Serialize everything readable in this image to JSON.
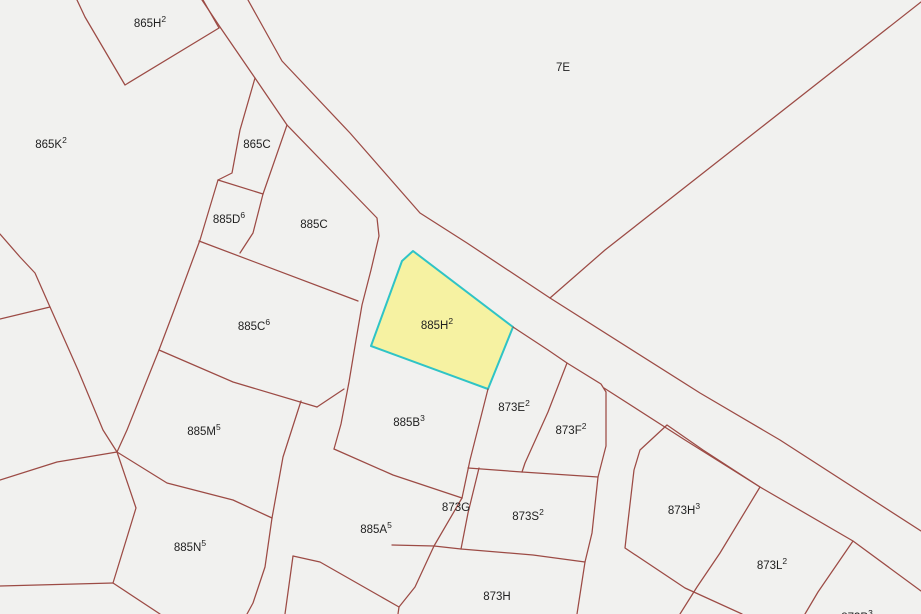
{
  "map": {
    "title": "Cadastral parcel map",
    "width": 921,
    "height": 614,
    "background_color": "#f1f1ef",
    "boundary_color": "#9c4b45",
    "label_color": "#1f1f1f",
    "label_font_size": 11.5,
    "sup_font_size": 8.5,
    "highlight": {
      "parcel": "885H2",
      "fill": "#f6f2a2",
      "stroke": "#2fc4c6",
      "stroke_width": 2,
      "points": [
        [
          413,
          251
        ],
        [
          402,
          261
        ],
        [
          371,
          346
        ],
        [
          488,
          389
        ],
        [
          513,
          327
        ]
      ]
    },
    "labels": [
      {
        "text": "865H",
        "sup": "2",
        "x": 150,
        "y": 27
      },
      {
        "text": "7E",
        "sup": "",
        "x": 563,
        "y": 71
      },
      {
        "text": "865K",
        "sup": "2",
        "x": 51,
        "y": 148
      },
      {
        "text": "865C",
        "sup": "",
        "x": 257,
        "y": 148
      },
      {
        "text": "885D",
        "sup": "6",
        "x": 229,
        "y": 223
      },
      {
        "text": "885C",
        "sup": "",
        "x": 314,
        "y": 228
      },
      {
        "text": "885C",
        "sup": "6",
        "x": 254,
        "y": 330
      },
      {
        "text": "885H",
        "sup": "2",
        "x": 437,
        "y": 329
      },
      {
        "text": "885M",
        "sup": "5",
        "x": 204,
        "y": 435
      },
      {
        "text": "885B",
        "sup": "3",
        "x": 409,
        "y": 426
      },
      {
        "text": "873E",
        "sup": "2",
        "x": 514,
        "y": 411
      },
      {
        "text": "873F",
        "sup": "2",
        "x": 571,
        "y": 434
      },
      {
        "text": "885A",
        "sup": "5",
        "x": 376,
        "y": 533
      },
      {
        "text": "873G",
        "sup": "",
        "x": 456,
        "y": 511
      },
      {
        "text": "873S",
        "sup": "2",
        "x": 528,
        "y": 520
      },
      {
        "text": "885N",
        "sup": "5",
        "x": 190,
        "y": 551
      },
      {
        "text": "873H",
        "sup": "",
        "x": 497,
        "y": 600
      },
      {
        "text": "873H",
        "sup": "3",
        "x": 684,
        "y": 514
      },
      {
        "text": "873L",
        "sup": "2",
        "x": 772,
        "y": 569
      },
      {
        "text": "873P",
        "sup": "3",
        "x": 857,
        "y": 621
      }
    ],
    "boundaries": [
      {
        "name": "road-left-upper",
        "points": [
          [
            202,
            0
          ],
          [
            220,
            27
          ],
          [
            255,
            78
          ],
          [
            287,
            125
          ],
          [
            377,
            218
          ],
          [
            379,
            236
          ],
          [
            371,
            270
          ],
          [
            362,
            305
          ],
          [
            356,
            340
          ],
          [
            349,
            382
          ],
          [
            341,
            424
          ],
          [
            334,
            449
          ]
        ]
      },
      {
        "name": "road-right",
        "points": [
          [
            248,
            0
          ],
          [
            282,
            61
          ],
          [
            350,
            133
          ],
          [
            420,
            213
          ],
          [
            467,
            243
          ],
          [
            550,
            298
          ],
          [
            700,
            393
          ],
          [
            780,
            440
          ],
          [
            921,
            531
          ]
        ]
      },
      {
        "name": "diagonal-7e",
        "points": [
          [
            921,
            2
          ],
          [
            605,
            250
          ],
          [
            550,
            298
          ]
        ]
      },
      {
        "name": "parcel-865h2-west",
        "points": [
          [
            77,
            0
          ],
          [
            85,
            17
          ],
          [
            125,
            85
          ],
          [
            219,
            28
          ]
        ]
      },
      {
        "name": "parcel-865h2-east",
        "points": [
          [
            203,
            0
          ],
          [
            219,
            28
          ]
        ]
      },
      {
        "name": "parcel-865c-west",
        "points": [
          [
            255,
            78
          ],
          [
            240,
            130
          ],
          [
            232,
            173
          ],
          [
            218,
            180
          ]
        ]
      },
      {
        "name": "parcel-865c-south",
        "points": [
          [
            218,
            180
          ],
          [
            263,
            194
          ]
        ]
      },
      {
        "name": "parcel-865c-east",
        "points": [
          [
            287,
            125
          ],
          [
            263,
            194
          ]
        ]
      },
      {
        "name": "column-west",
        "points": [
          [
            218,
            180
          ],
          [
            200,
            240
          ],
          [
            173,
            313
          ],
          [
            159,
            350
          ],
          [
            127,
            430
          ],
          [
            117,
            452
          ]
        ]
      },
      {
        "name": "parcel-885d6-east",
        "points": [
          [
            263,
            194
          ],
          [
            253,
            233
          ],
          [
            240,
            253
          ]
        ]
      },
      {
        "name": "parcel-885c6-north",
        "points": [
          [
            199,
            241
          ],
          [
            358,
            301
          ]
        ]
      },
      {
        "name": "parcel-885c6-south",
        "points": [
          [
            159,
            350
          ],
          [
            233,
            382
          ],
          [
            317,
            407
          ]
        ]
      },
      {
        "name": "parcel-885c6-east",
        "points": [
          [
            317,
            407
          ],
          [
            344,
            389
          ]
        ]
      },
      {
        "name": "wedge-curve",
        "points": [
          [
            0,
            234
          ],
          [
            20,
            257
          ],
          [
            35,
            273
          ],
          [
            50,
            307
          ],
          [
            78,
            370
          ],
          [
            103,
            430
          ],
          [
            117,
            452
          ]
        ]
      },
      {
        "name": "wedge-line",
        "points": [
          [
            50,
            307
          ],
          [
            0,
            319
          ]
        ]
      },
      {
        "name": "west-line",
        "points": [
          [
            117,
            452
          ],
          [
            57,
            462
          ],
          [
            0,
            480
          ]
        ]
      },
      {
        "name": "a-b-line",
        "points": [
          [
            117,
            452
          ],
          [
            136,
            508
          ],
          [
            113,
            583
          ]
        ]
      },
      {
        "name": "b-west",
        "points": [
          [
            113,
            583
          ],
          [
            0,
            586
          ]
        ]
      },
      {
        "name": "b-south",
        "points": [
          [
            113,
            583
          ],
          [
            160,
            614
          ]
        ]
      },
      {
        "name": "mn-divider",
        "points": [
          [
            117,
            452
          ],
          [
            167,
            483
          ],
          [
            233,
            500
          ],
          [
            272,
            518
          ]
        ]
      },
      {
        "name": "m-east",
        "points": [
          [
            301,
            401
          ],
          [
            283,
            457
          ],
          [
            272,
            518
          ]
        ]
      },
      {
        "name": "n-east",
        "points": [
          [
            272,
            518
          ],
          [
            265,
            567
          ],
          [
            253,
            603
          ],
          [
            247,
            614
          ]
        ]
      },
      {
        "name": "sliver-west",
        "points": [
          [
            293,
            556
          ],
          [
            285,
            614
          ]
        ]
      },
      {
        "name": "a5-south",
        "points": [
          [
            293,
            556
          ],
          [
            320,
            562
          ],
          [
            399,
            607
          ],
          [
            398,
            614
          ]
        ]
      },
      {
        "name": "h-diagonal",
        "points": [
          [
            434,
            546
          ],
          [
            415,
            587
          ],
          [
            399,
            607
          ]
        ]
      },
      {
        "name": "b3-south",
        "points": [
          [
            334,
            449
          ],
          [
            393,
            475
          ],
          [
            462,
            498
          ]
        ]
      },
      {
        "name": "b3-east",
        "points": [
          [
            488,
            389
          ],
          [
            470,
            460
          ],
          [
            462,
            498
          ]
        ]
      },
      {
        "name": "j4-down",
        "points": [
          [
            462,
            498
          ],
          [
            434,
            546
          ]
        ]
      },
      {
        "name": "g-east",
        "points": [
          [
            479,
            468
          ],
          [
            468,
            513
          ],
          [
            461,
            549
          ]
        ]
      },
      {
        "name": "s2-north",
        "points": [
          [
            468,
            468
          ],
          [
            522,
            472
          ],
          [
            598,
            477
          ]
        ]
      },
      {
        "name": "ef-divider",
        "points": [
          [
            567,
            363
          ],
          [
            548,
            412
          ],
          [
            525,
            463
          ],
          [
            522,
            472
          ]
        ]
      },
      {
        "name": "f-east",
        "points": [
          [
            513,
            327
          ],
          [
            548,
            350
          ],
          [
            567,
            363
          ],
          [
            601,
            384
          ],
          [
            606,
            392
          ],
          [
            606,
            446
          ],
          [
            598,
            477
          ],
          [
            592,
            533
          ],
          [
            585,
            562
          ],
          [
            577,
            614
          ]
        ]
      },
      {
        "name": "road-left-lower",
        "points": [
          [
            604,
            388
          ],
          [
            685,
            440
          ],
          [
            760,
            487
          ],
          [
            853,
            541
          ],
          [
            921,
            591
          ]
        ]
      },
      {
        "name": "sh-divider",
        "points": [
          [
            392,
            545
          ],
          [
            434,
            546
          ],
          [
            461,
            549
          ],
          [
            533,
            555
          ],
          [
            585,
            562
          ]
        ]
      },
      {
        "name": "h3-west",
        "points": [
          [
            667,
            425
          ],
          [
            640,
            450
          ],
          [
            634,
            470
          ],
          [
            627,
            530
          ],
          [
            625,
            548
          ],
          [
            685,
            588
          ],
          [
            742,
            614
          ]
        ]
      },
      {
        "name": "h3-northeast",
        "points": [
          [
            667,
            425
          ],
          [
            703,
            450
          ],
          [
            760,
            487
          ]
        ]
      },
      {
        "name": "l2-west",
        "points": [
          [
            760,
            487
          ],
          [
            720,
            553
          ],
          [
            697,
            587
          ],
          [
            680,
            614
          ]
        ]
      },
      {
        "name": "l2-east",
        "points": [
          [
            853,
            541
          ],
          [
            818,
            592
          ],
          [
            805,
            614
          ]
        ]
      }
    ]
  }
}
